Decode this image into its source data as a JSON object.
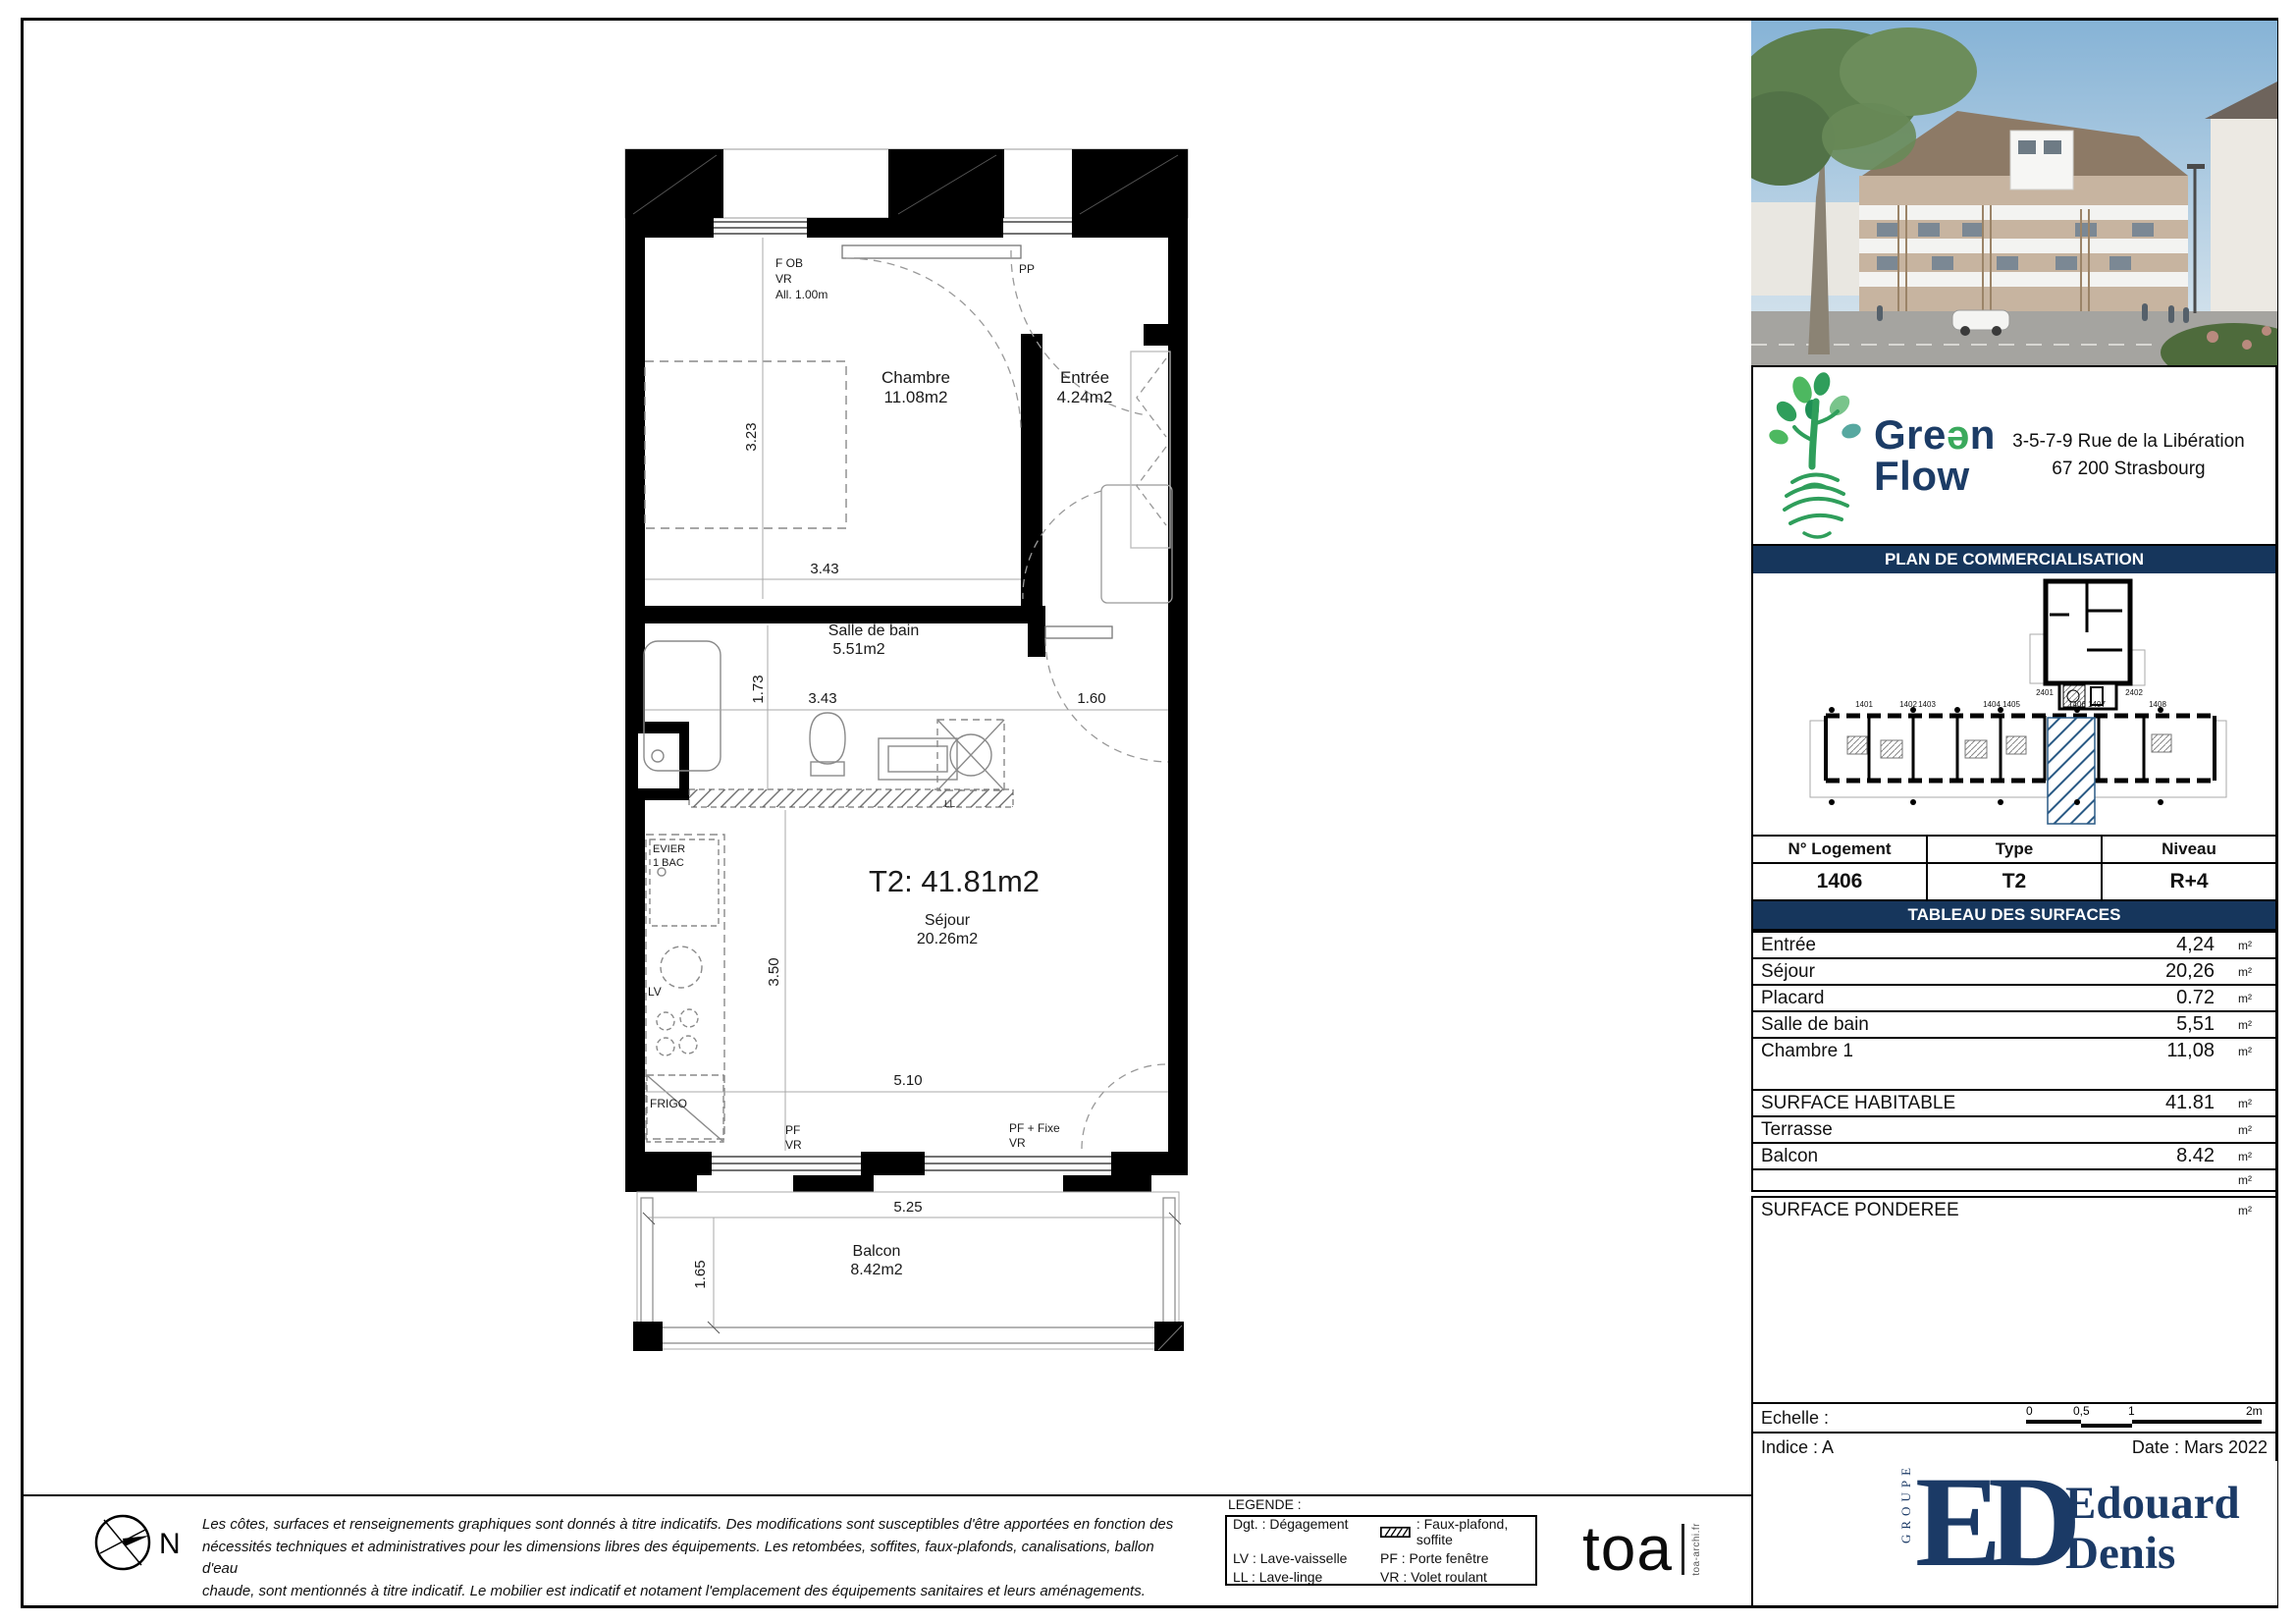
{
  "colors": {
    "navy": "#16365c",
    "brand_green": "#3aa95c",
    "highlight_blue": "#2a5a85"
  },
  "plan": {
    "title": "T2: 41.81m2",
    "rooms": {
      "chambre": {
        "name": "Chambre",
        "area": "11.08m2"
      },
      "entree": {
        "name": "Entrée",
        "area": "4.24m2"
      },
      "sdb": {
        "name": "Salle de bain",
        "area": "5.51m2"
      },
      "sejour": {
        "name": "Séjour",
        "area": "20.26m2"
      },
      "balcon": {
        "name": "Balcon",
        "area": "8.42m2"
      }
    },
    "ann": {
      "fob": "F OB",
      "vr": "VR",
      "all": "All. 1.00m",
      "pp": "PP",
      "evier": "EVIER",
      "bac": "1 BAC",
      "lv": "LV",
      "frigo": "FRIGO",
      "pf": "PF",
      "vr_b": "VR",
      "pf_fixe": "PF + Fixe",
      "vr_c": "VR",
      "ll": "LL"
    },
    "dims": {
      "d323": "3.23",
      "d343a": "3.43",
      "d173": "1.73",
      "d343b": "3.43",
      "d160": "1.60",
      "d350": "3.50",
      "d510": "5.10",
      "d525": "5.25",
      "d165": "1.65"
    }
  },
  "compass": {
    "label": "N"
  },
  "disclaimer": {
    "line1": "Les côtes, surfaces et renseignements graphiques sont donnés à titre indicatifs. Des modifications sont susceptibles d'être apportées en fonction des",
    "line2": "nécessités techniques et administratives pour les dimensions libres des équipements. Les retombées, soffites, faux-plafonds, canalisations, ballon d'eau",
    "line3": "chaude, sont mentionnés à titre indicatif. Le mobilier est indicatif et notament l'emplacement des équipements sanitaires et leurs aménagements."
  },
  "legend": {
    "title": "LEGENDE :",
    "dgt": "Dgt. : Dégagement",
    "faux_plafond": ": Faux-plafond, soffite",
    "lv": "LV : Lave-vaisselle",
    "pf": "PF : Porte fenêtre",
    "ll": "LL : Lave-linge",
    "vr": "VR : Volet roulant"
  },
  "toa": {
    "word": "toa",
    "url": "toa-archi.fr"
  },
  "sidebar": {
    "brand": {
      "g1": "Gre",
      "schwa": "ə",
      "g2": "n",
      "flow": "Flow"
    },
    "address_line1": "3-5-7-9 Rue de la Libération",
    "address_line2": "67 200 Strasbourg",
    "plan_header": "PLAN DE COMMERCIALISATION",
    "unit_table": {
      "headers": [
        "N° Logement",
        "Type",
        "Niveau"
      ],
      "values": [
        "1406",
        "T2",
        "R+4"
      ]
    },
    "surfaces_header": "TABLEAU DES SURFACES",
    "surfaces": [
      {
        "label": "Entrée",
        "value": "4,24",
        "unit": "m²"
      },
      {
        "label": "Séjour",
        "value": "20,26",
        "unit": "m²"
      },
      {
        "label": "Placard",
        "value": "0.72",
        "unit": "m²"
      },
      {
        "label": "Salle de bain",
        "value": "5,51",
        "unit": "m²"
      },
      {
        "label": "Chambre 1",
        "value": "11,08",
        "unit": "m²"
      }
    ],
    "totals": [
      {
        "label": "SURFACE HABITABLE",
        "value": "41.81",
        "unit": "m²"
      },
      {
        "label": "Terrasse",
        "value": "",
        "unit": "m²"
      },
      {
        "label": "Balcon",
        "value": "8.42",
        "unit": "m²"
      },
      {
        "label": "",
        "value": "",
        "unit": "m²"
      },
      {
        "label": "SURFACE PONDEREE",
        "value": "",
        "unit": "m²"
      }
    ],
    "echelle_label": "Echelle :",
    "scale_ticks": [
      "0",
      "0,5",
      "1",
      "2m"
    ],
    "indice": "Indice : A",
    "date": "Date : Mars 2022",
    "groupe": "GROUPE",
    "monogram1": "E",
    "monogram2": "D",
    "dev1": "Edouard",
    "dev2": "Denis",
    "site_units": [
      "1401",
      "1402",
      "1403",
      "1404",
      "1405",
      "1406",
      "1407",
      "1408",
      "2401",
      "2402"
    ]
  }
}
